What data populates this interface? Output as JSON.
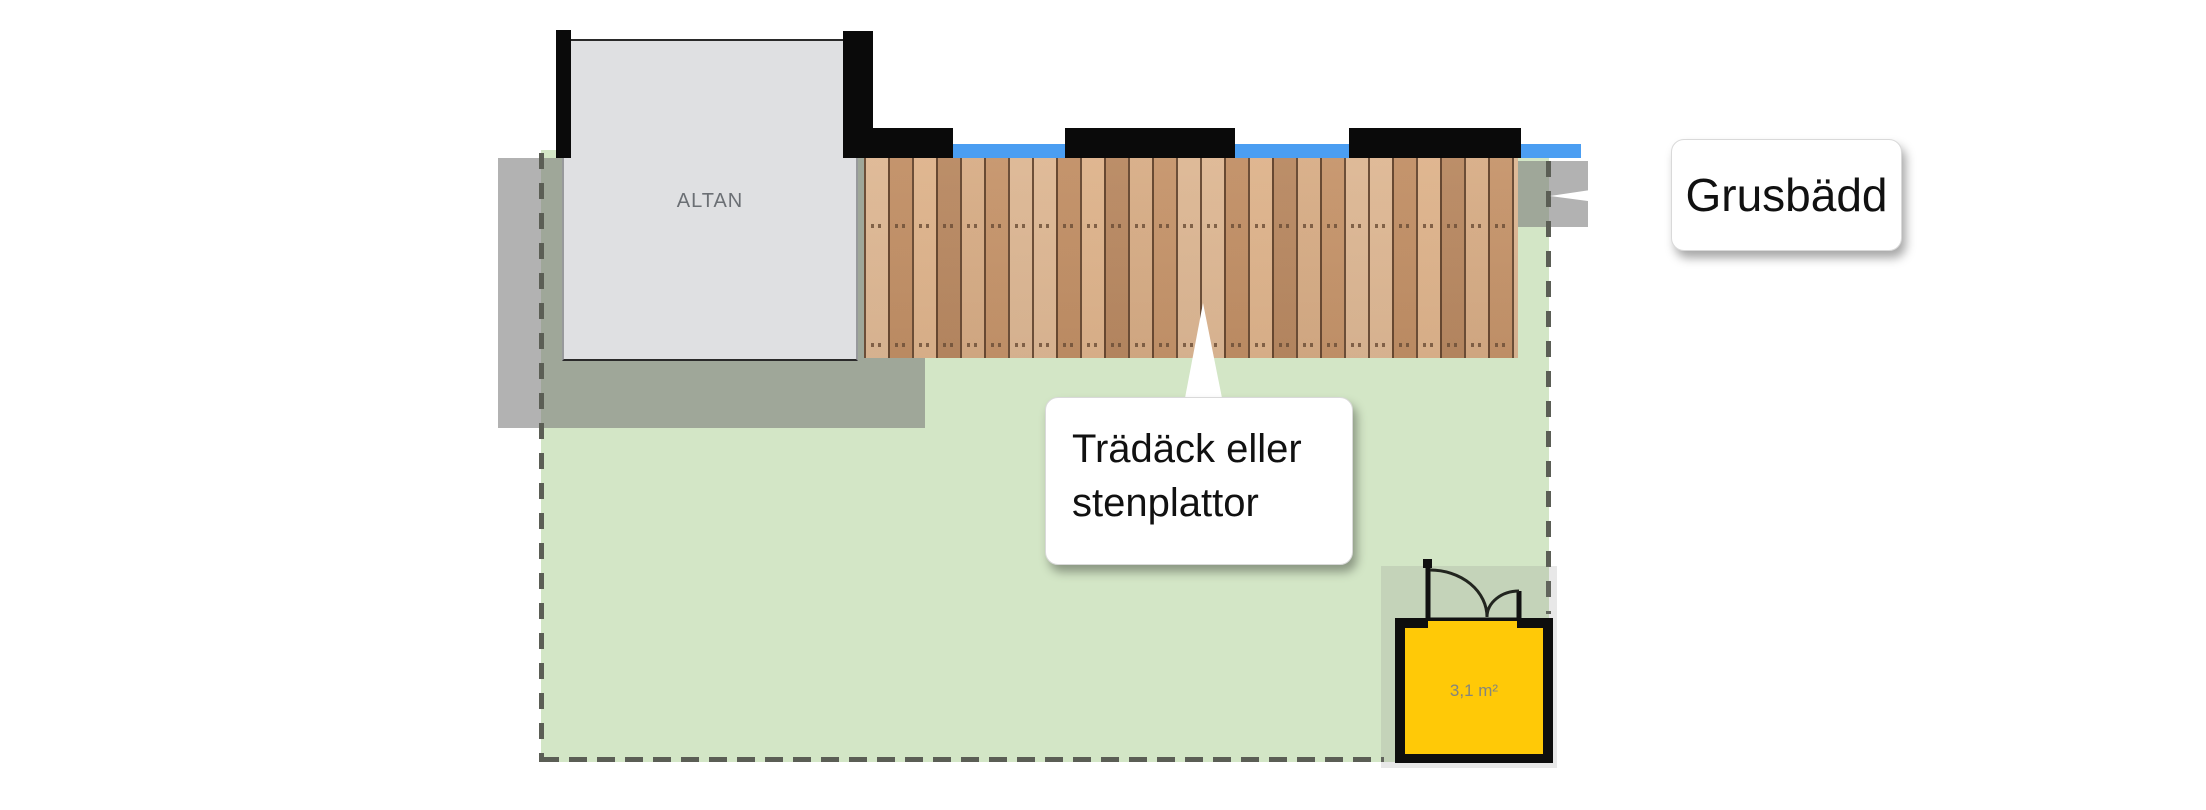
{
  "plan": {
    "labels": {
      "altan": "ALTAN",
      "shed_area": "3,1 m²"
    },
    "callouts": {
      "grusbadd": {
        "text": "Grusbädd"
      },
      "tradack": {
        "line1": "Trädäck eller",
        "line2": "stenplattor"
      }
    },
    "colors": {
      "lawn_green": "#d3e6c6",
      "gravel_gray": "#767676",
      "water_blue": "#4b9ef2",
      "shed_yellow": "#ffc907",
      "wood_tan": "#cfa076",
      "wall_black": "#0a0a0a",
      "boundary_dash_gray": "#5b5e55",
      "altan_slab_gray": "#dfe0e2"
    }
  }
}
